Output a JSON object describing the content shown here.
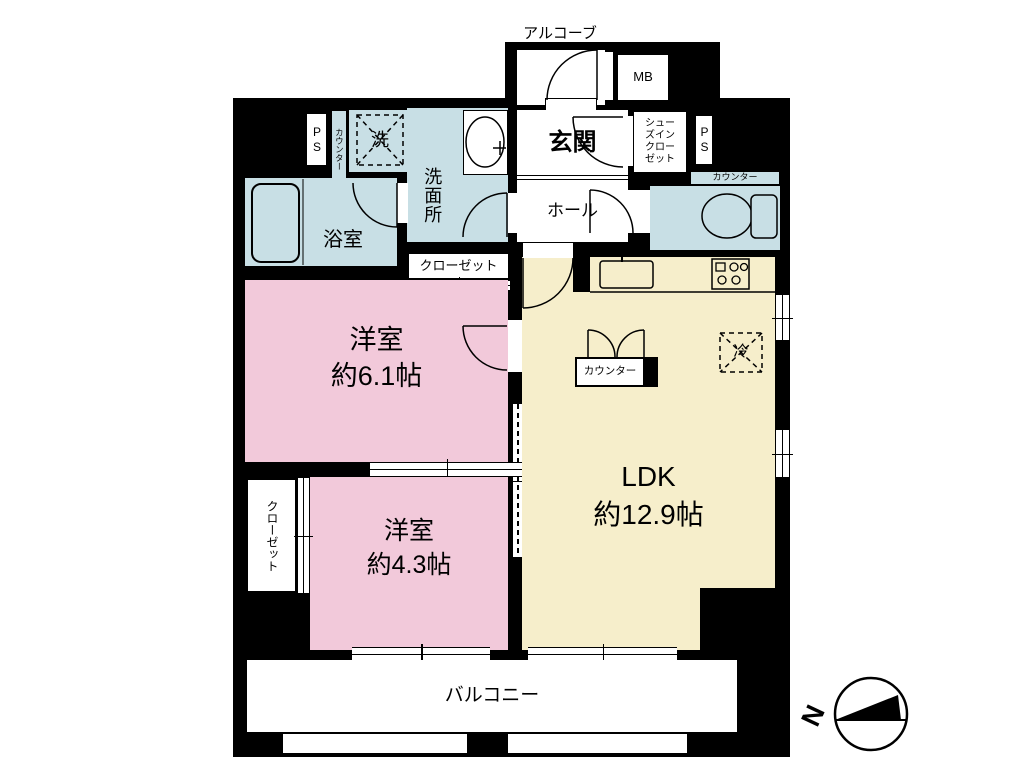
{
  "plan": {
    "alcove": "アルコーブ",
    "mb": "MB",
    "entrance": "玄関",
    "hall": "ホール",
    "shoe_closet_lines": [
      "シュー",
      "ズイン",
      "クロー",
      "ゼット"
    ],
    "ps_right": "PS",
    "ps_left": "PS",
    "counter_top_left": "カウンター",
    "counter_toilet": "カウンター",
    "counter_ldk": "カウンター",
    "washer": "洗",
    "fridge": "冷",
    "washroom": "洗面所",
    "bathroom": "浴室",
    "closet_upper": "クローゼット",
    "closet_lower": "クローゼット",
    "western_room_1": {
      "name": "洋室",
      "size": "約6.1帖"
    },
    "western_room_2": {
      "name": "洋室",
      "size": "約4.3帖"
    },
    "ldk": {
      "name": "LDK",
      "size": "約12.9帖"
    },
    "balcony": "バルコニー",
    "compass_north": "N"
  },
  "colors": {
    "wall": "#000000",
    "white": "#ffffff",
    "blue": "#c8dfe5",
    "pink": "#f2c9da",
    "cream": "#f6eecb"
  }
}
